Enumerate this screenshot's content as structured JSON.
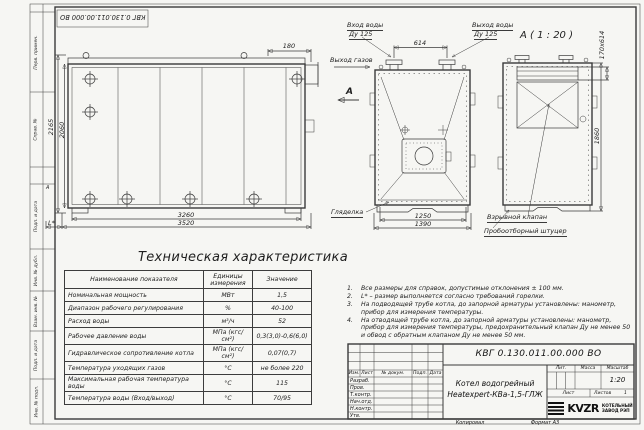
{
  "doc": {
    "number": "КВГ 0.130.011.00.000 ВО",
    "number_top": "КВГ 0.130.011.00.000 ВО",
    "title_line1": "Котел водогрейный",
    "title_line2": "Heatexpert-КВа-1,5-ГЛЖ",
    "lit_label": "Лит.",
    "mass_label": "Масса",
    "scale_label": "Масштаб",
    "scale": "1:20",
    "sheet_label": "Лист",
    "sheets_label": "Листов",
    "sheets_value": "1",
    "copied": "Копировал",
    "format": "Формат А3"
  },
  "company": {
    "logo": "KVZR",
    "line1": "КОТЕЛЬНЫЙ",
    "line2": "ЗАВОД РЭП"
  },
  "rev_headers": [
    "Изм.",
    "Лист",
    "№ докум.",
    "Подп.",
    "Дата"
  ],
  "sign_rows": [
    "Разраб.",
    "Пров.",
    "Т.контр.",
    "Нач.отд.",
    "Н.контр.",
    "Утв."
  ],
  "frame_strips": [
    "Перв. примен.",
    "Справ. №",
    "Подп. и дата",
    "Инв. № дубл.",
    "Взам. инв. №",
    "Подп. и дата",
    "Инв. № подл."
  ],
  "zone_marker": "А",
  "views": {
    "side": {
      "dim_180": "180",
      "dim_2165": "2165",
      "dim_2060": "2060",
      "dim_3260": "3260",
      "dim_3520": "3520",
      "dim_l": "L*",
      "gas_out": "Выход газов",
      "section": "А"
    },
    "front": {
      "water_in_1": "Вход воды",
      "water_in_2": "Ду 125",
      "water_out_1": "Выход воды",
      "water_out_2": "Ду 125",
      "dim_614": "614",
      "dim_1250": "1250",
      "dim_1390": "1390",
      "sight": "Гляделка"
    },
    "detail": {
      "title": "А ( 1 : 20 )",
      "dim_duct": "170х614",
      "dim_1860": "1860",
      "explosion": "Взрывной клапан",
      "sampling": "Пробоотборный штуцер"
    }
  },
  "spec": {
    "title": "Техническая характеристика",
    "headers": [
      "Наименование показателя",
      "Единицы измерения",
      "Значение"
    ],
    "rows": [
      [
        "Номинальная мощность",
        "МВт",
        "1,5"
      ],
      [
        "Диапазон рабочего регулирования",
        "%",
        "40-100"
      ],
      [
        "Расход воды",
        "м³/ч",
        "52"
      ],
      [
        "Рабочее давление воды",
        "МПа (кгс/см²)",
        "0,3(3,0)-0,6(6,0)"
      ],
      [
        "Гидравлическое сопротивление котла",
        "МПа (кгс/см²)",
        "0,07(0,7)"
      ],
      [
        "Температура уходящих газов",
        "°С",
        "не более 220"
      ],
      [
        "Максимальная рабочая температура воды",
        "°С",
        "115"
      ],
      [
        "Температура воды (Вход/выход)",
        "°С",
        "70/95"
      ]
    ]
  },
  "notes": [
    {
      "num": "1.",
      "text": "Все размеры для справок, допустимые отклонения ± 100 мм."
    },
    {
      "num": "2.",
      "text": "L* – размер выполняется согласно требований горелки."
    },
    {
      "num": "3.",
      "text": "На подводящей трубе котла, до запорной арматуры установлены: манометр, прибор для измерения температуры."
    },
    {
      "num": "4.",
      "text": "На отводящей трубе котла, до запорной арматуры установлены: манометр, прибор для измерения температуры, предохранительный клапан Ду не менее 50 и обвод с обратным клапаном Ду не менее 50 мм."
    }
  ]
}
